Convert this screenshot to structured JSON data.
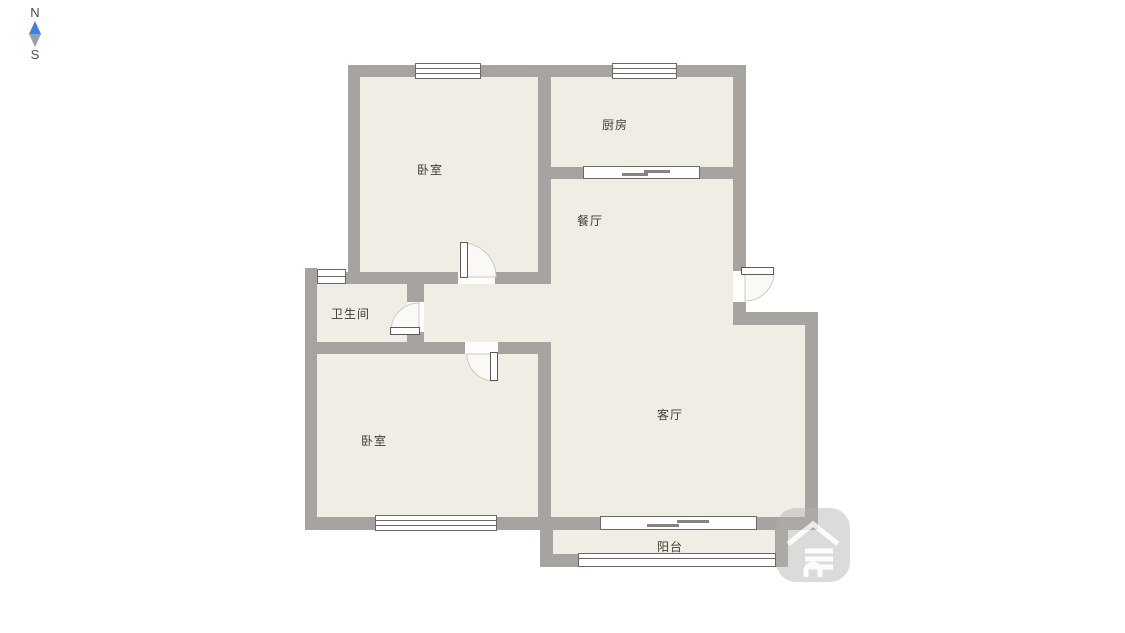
{
  "compass": {
    "north": "N",
    "south": "S"
  },
  "rooms": {
    "bedroom_top": {
      "label": "卧室"
    },
    "kitchen": {
      "label": "厨房"
    },
    "dining": {
      "label": "餐厅"
    },
    "bathroom": {
      "label": "卫生间"
    },
    "bedroom_bottom": {
      "label": "卧室"
    },
    "living": {
      "label": "客厅"
    },
    "balcony": {
      "label": "阳台"
    }
  },
  "watermark": {
    "icon": "house-logo"
  },
  "colors": {
    "wall": "#a6a3a0",
    "floor": "#f0ede4",
    "line": "#6b6966",
    "arcfill": "#faf9f6",
    "arcstroke": "#ccc9c3",
    "textcol": "#3f3d3b",
    "cnorth": "#3e7fe8",
    "csouth": "#98a0a8",
    "wmark": "#b3b0ad"
  }
}
